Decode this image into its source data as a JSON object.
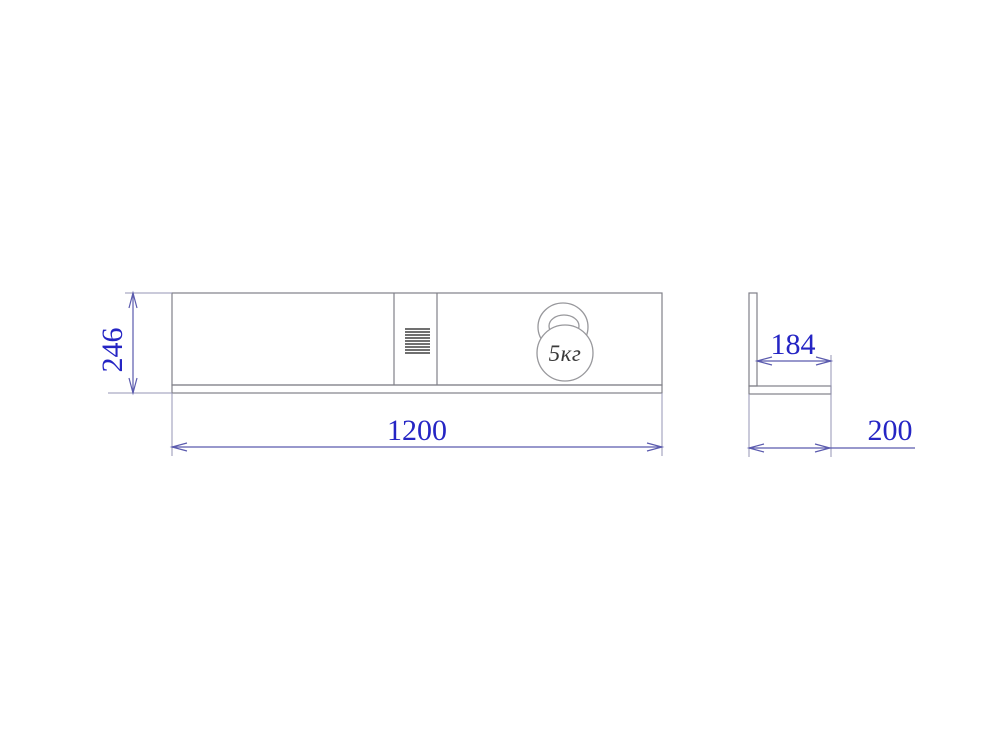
{
  "drawing": {
    "kind": "technical-drawing",
    "front_view": {
      "width_label": "1200",
      "height_label": "246",
      "load_label": "5кг"
    },
    "side_view": {
      "inner_depth_label": "184",
      "depth_label": "200"
    },
    "colors": {
      "object_line": "#808088",
      "weight_line": "#98989c",
      "hatch_line": "#404040",
      "extension_line": "#9494b4",
      "dimension_line": "#5b5bae",
      "dimension_text": "#2525c4",
      "weight_text": "#3a3a3a",
      "background": "#ffffff"
    }
  }
}
